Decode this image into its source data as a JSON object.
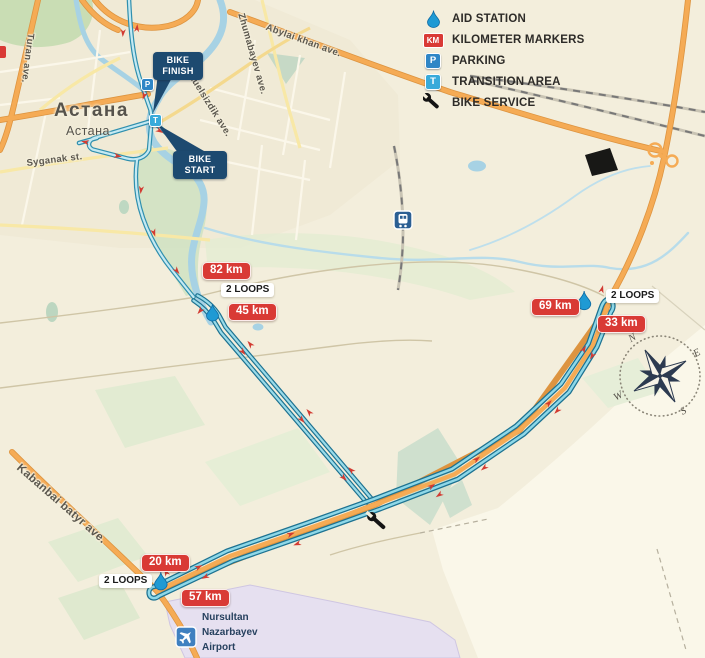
{
  "legend": {
    "aid_station": "AID STATION",
    "km_markers": "KILOMETER MARKERS",
    "parking": "PARKING",
    "transition": "TRANSITION AREA",
    "bike_service": "BIKE SERVICE",
    "km_badge": "KM",
    "parking_badge": "P",
    "transition_badge": "T"
  },
  "city": {
    "name_primary": "Астана",
    "name_secondary": "Астана"
  },
  "streets": {
    "turan": "Turan ave.",
    "syganak": "Syganak st.",
    "tauelsizdik": "Tauelsizdik ave.",
    "abylai": "Abylai khan ave.",
    "zhumabayev": "Zhumabayev ave.",
    "kabanbai": "Kabanbai batyr ave."
  },
  "callouts": {
    "finish_l1": "BIKE",
    "finish_l2": "FINISH",
    "start_l1": "BIKE",
    "start_l2": "START"
  },
  "course": {
    "km_82": "82 km",
    "km_45": "45 km",
    "km_69": "69 km",
    "km_33": "33 km",
    "km_20": "20 km",
    "km_57": "57 km",
    "loops_city": "2 LOOPS",
    "loops_ne": "2 LOOPS",
    "loops_sw": "2 LOOPS",
    "parking_badge": "P",
    "transition_badge": "T"
  },
  "airport": {
    "l1": "Nursultan",
    "l2": "Nazarbayev",
    "l3": "Airport"
  },
  "compass": {
    "n": "N",
    "e": "E",
    "s": "S",
    "w": "W"
  },
  "colors": {
    "marker_red": "#d93a35",
    "route_dark": "#1d7291",
    "route_light": "#8ed8e8",
    "navy": "#1d4a70",
    "road_orange": "#f5ab55"
  }
}
